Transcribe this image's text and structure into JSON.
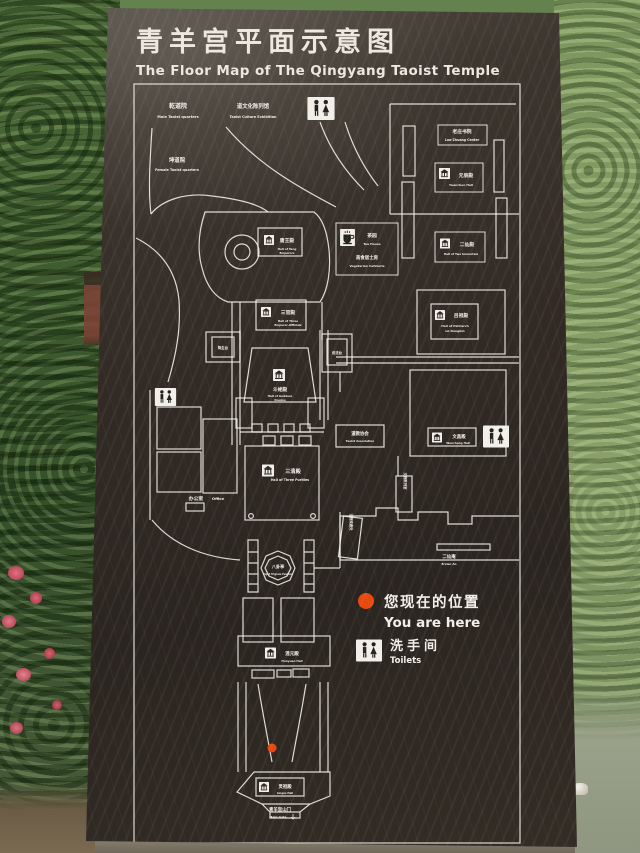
{
  "sign": {
    "title_zh": "青羊宫平面示意图",
    "title_en": "The Floor Map of The Qingyang Taoist Temple"
  },
  "map": {
    "buildings": {
      "male_taoist_quarters": {
        "zh": "乾道院",
        "en": "Male Taoist quarters"
      },
      "taoist_culture_exhibition": {
        "zh": "道文化陈列馆",
        "en": "Taoist Culture Exhibition"
      },
      "female_taoist_quarters": {
        "zh": "坤道院",
        "en": "Female Taoist quarters"
      },
      "laozhuang_center": {
        "zh": "老庄书院",
        "en": "Lao-Zhuang Center"
      },
      "yuanchen_hall": {
        "zh": "元辰殿",
        "en": "Yuanchen Hall"
      },
      "hall_of_two_immortals": {
        "zh": "二仙殿",
        "en": "Hall of Two Immortals"
      },
      "hall_of_patriarch_lv": {
        "zh": "吕祖殿",
        "en": "Hall of Patriarch",
        "en2": "Lü Dongbin"
      },
      "tea_house": {
        "zh": "茶园",
        "en": "Tea House"
      },
      "vegetarian_cafeteria": {
        "zh": "斋食居士房",
        "en": "Vegetarian Cafeteria"
      },
      "hall_of_tang_emperors": {
        "zh": "唐王殿",
        "en": "Hall of Tang",
        "en2": "Emperors"
      },
      "hall_of_three_officials": {
        "zh": "三官殿",
        "en": "Hall of Three",
        "en2": "Emperor-Officials"
      },
      "hall_of_goddess_doumu": {
        "zh": "斗姥殿",
        "en": "Hall of Goddess",
        "en2": "Doumu"
      },
      "jiangsheng_terrace": {
        "zh": "降生台"
      },
      "shuofa_terrace": {
        "zh": "说法台"
      },
      "taoist_association": {
        "zh": "道教协会",
        "en": "Taoist Association"
      },
      "hall_of_three_purities": {
        "zh": "三清殿",
        "en": "Hall of Three Purities"
      },
      "office": {
        "zh": "办公室",
        "en": "Office"
      },
      "wenchang_hall": {
        "zh": "文昌殿",
        "en": "Wenchang Hall"
      },
      "eight_trigram_pavilion": {
        "zh": "八卦亭",
        "en": "Eight Trigram Pavilion"
      },
      "dharma_shop": {
        "zh": "法物流通处"
      },
      "relics_room": {
        "zh": "文物陈列室"
      },
      "erxian_an": {
        "zh": "二仙庵",
        "en": "Erxian An"
      },
      "hunyuan_hall": {
        "zh": "混元殿",
        "en": "Hunyuan Hall"
      },
      "lingzu_hall": {
        "zh": "灵祖殿",
        "en": "Lingzu Hall"
      },
      "main_gate": {
        "zh": "青羊宫山门",
        "en": "Main Gate"
      }
    },
    "legend": {
      "you_are_here_zh": "您现在的位置",
      "you_are_here_en": "You are here",
      "toilets_zh": "洗手间",
      "toilets_en": "Toilets"
    }
  },
  "colors": {
    "accent_red": "#e8490f",
    "line_white": "#f2efe9"
  }
}
